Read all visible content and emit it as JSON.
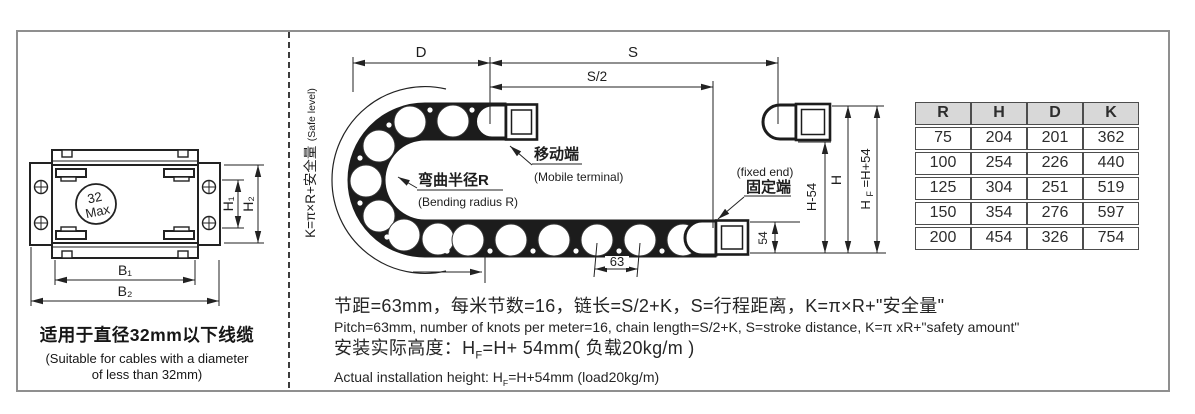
{
  "left_panel": {
    "circle_line1": "32",
    "circle_line2": "Max",
    "dim_h1": "H₁",
    "dim_h2": "H₂",
    "dim_b1": "B₁",
    "dim_b2": "B₂",
    "caption_zh": "适用于直径32mm以下线缆",
    "caption_en1": "(Suitable for cables with a diameter",
    "caption_en2": "of less than 32mm)"
  },
  "diagram": {
    "safe_level_zh": "K=π×R+安全量",
    "safe_level_en": "(Safe level)",
    "dim_d": "D",
    "dim_s": "S",
    "dim_s_half": "S/2",
    "bend_zh": "弯曲半径R",
    "bend_en": "(Bending radius R)",
    "mobile_zh": "移动端",
    "mobile_en": "(Mobile terminal)",
    "fixed_en": "(fixed end)",
    "fixed_zh": "固定端",
    "dim_63": "63",
    "dim_54": "54",
    "dim_h_minus_54": "H-54",
    "dim_h": "H",
    "hf_base": "H",
    "hf_sub": "F",
    "hf_rest": "=H+54"
  },
  "table": {
    "headers": [
      "R",
      "H",
      "D",
      "K"
    ],
    "rows": [
      [
        "75",
        "204",
        "201",
        "362"
      ],
      [
        "100",
        "254",
        "226",
        "440"
      ],
      [
        "125",
        "304",
        "251",
        "519"
      ],
      [
        "150",
        "354",
        "276",
        "597"
      ],
      [
        "200",
        "454",
        "326",
        "754"
      ]
    ]
  },
  "notes": {
    "line1_zh": "节距=63mm，每米节数=16，链长=S/2+K，S=行程距离，K=π×R+\"安全量\"",
    "line1_en": "Pitch=63mm, number of knots per meter=16, chain length=S/2+K, S=stroke distance, K=π xR+\"safety amount\"",
    "line2_zh_a": "安装实际高度：H",
    "line2_zh_sub": "F",
    "line2_zh_b": "=H+ 54mm( 负载20kg/m )",
    "line2_en_a": "Actual installation height: H",
    "line2_en_sub": "F",
    "line2_en_b": "=H+54mm (load20kg/m)"
  }
}
